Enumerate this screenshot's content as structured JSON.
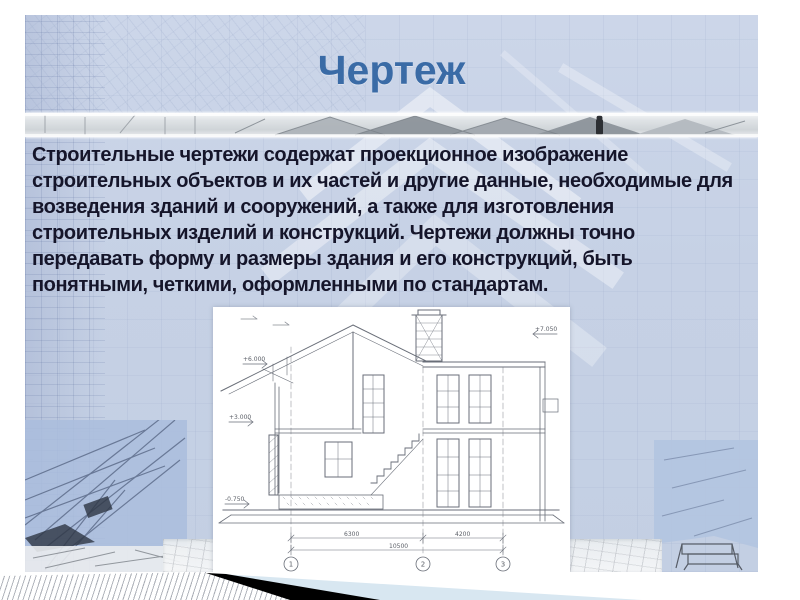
{
  "slide": {
    "title": "Чертеж",
    "body_text": "Строительные чертежи содержат проекционное изображение строительных объектов и их частей и другие данные, необходимые для возведения зданий и сооружений, а также для изготовления строительных изделий и конструкций. Чертежи должны точно передавать форму и размеры здания и его конструкций, быть понятными, четкими, оформленными по стандартам."
  },
  "colors": {
    "slide_background": "#c6d1e5",
    "title_text": "#3a6ba6",
    "body_text": "#15152a",
    "footer_black": "#000000",
    "footer_blue": "#d8e7f1",
    "blueprint_stroke": "#696e78"
  },
  "drawing": {
    "name": "house-cross-section-blueprint",
    "dimension_labels": {
      "left_span": "6300",
      "right_span": "4200",
      "total_span": "10500"
    },
    "axis_labels": [
      "1",
      "2",
      "3"
    ],
    "elevation_labels": {
      "right_top": "+7.050",
      "left_upper": "+6.000",
      "left_mid": "+3.000",
      "left_lower": "-0.750"
    }
  }
}
